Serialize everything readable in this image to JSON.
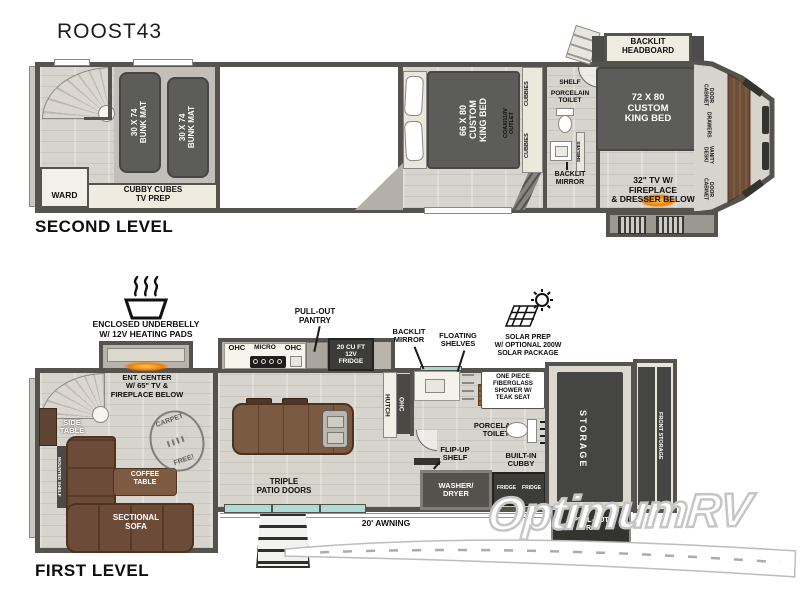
{
  "title": "ROOST43",
  "watermark": {
    "text": "OptimumRV"
  },
  "second_level": {
    "label": "SECOND LEVEL",
    "bunk_mat": "30 X 74\nBUNK MAT",
    "ward": "WARD",
    "cubby_cubes": "CUBBY CUBES\nTV PREP",
    "king_bed_mid": "66 X 80\nCUSTOM\nKING BED",
    "coax_outlet": "COAX/110V\nOUTLET",
    "cubbies": "CUBBIES",
    "shelf": "SHELF",
    "porcelain_toilet": "PORCELAIN\nTOILET",
    "shelves": "SHELVES",
    "backlit_mirror": "BACKLIT\nMIRROR",
    "backlit_headboard": "BACKLIT\nHEADBOARD",
    "king_bed_front": "72 X 80\nCUSTOM\nKING BED",
    "cabinet_door": "CABINET\nDOOR",
    "drawers": "DRAWERS",
    "desk_vanity": "DESK/\nVANITY",
    "tv_fireplace": "32\" TV W/\nFIREPLACE\n& DRESSER BELOW"
  },
  "first_level": {
    "label": "FIRST LEVEL",
    "underbelly": "ENCLOSED UNDERBELLY\nW/ 12V HEATING PADS",
    "ent_center": "ENT. CENTER\nW/ 65\" TV &\nFIREPLACE BELOW",
    "side_table": "SIDE\nTABLE",
    "mounted_shelf": "MOUNTED SHELF",
    "coffee_table": "COFFEE\nTABLE",
    "sectional_sofa": "SECTIONAL\nSOFA",
    "carpet_free_top": "CARPET",
    "carpet_free_bottom": "FREE!",
    "ohc_left": "OHC",
    "micro": "MICRO",
    "ohc_right": "OHC",
    "pull_out_pantry": "PULL-OUT\nPANTRY",
    "fridge": "20 CU FT\n12V\nFRIDGE",
    "hutch": "HUTCH",
    "ohc_vertical": "OHC",
    "triple_patio_doors": "TRIPLE\nPATIO DOORS",
    "awning": "20' AWNING",
    "backlit_mirror": "BACKLIT\nMIRROR",
    "floating_shelves": "FLOATING\nSHELVES",
    "solar": "SOLAR PREP\nW/ OPTIONAL 200W\nSOLAR PACKAGE",
    "shower": "ONE PIECE\nFIBERGLASS\nSHOWER W/\nTEAK SEAT",
    "porcelain_toilet": "PORCELAIN\nTOILET",
    "flip_up_shelf": "FLIP-UP\nSHELF",
    "built_in_cubby": "BUILT-IN\nCUBBY",
    "washer_dryer": "WASHER/\nDRYER",
    "fridge_small": "FRIDGE",
    "storage": "STORAGE",
    "front_storage": "FRONT STORAGE",
    "pull_out_tray": "PULL-OUT\nTRAY"
  }
}
